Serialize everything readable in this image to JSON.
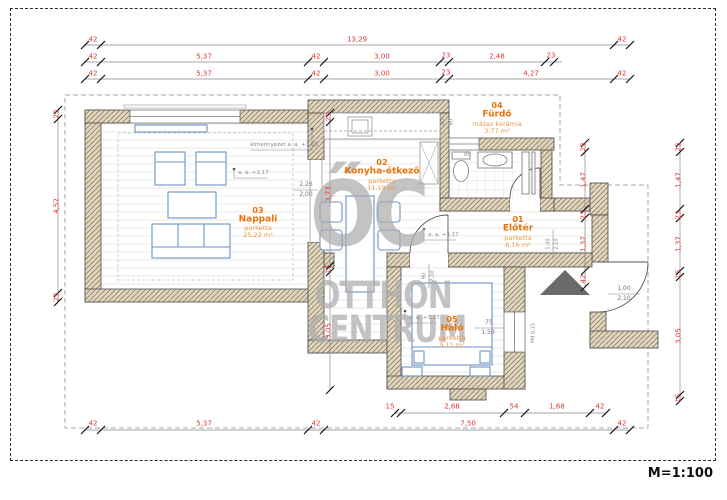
{
  "scale_label": "M=1:100",
  "watermark": {
    "logo": "ŐC",
    "line1": "OTTHON",
    "line2": "CENTRUM"
  },
  "rooms": {
    "nappali": {
      "number": "03",
      "name": "Nappali",
      "floor": "parketta",
      "area": "25,22 m²"
    },
    "konyha": {
      "number": "02",
      "name": "Konyha-étkező",
      "floor": "parketta",
      "area": "11,19 m²"
    },
    "furdo": {
      "number": "04",
      "name": "Fürdő",
      "floor": "mázas kerámia",
      "area": "3,77 m²"
    },
    "eloter": {
      "number": "01",
      "name": "Előtér",
      "floor": "parketta",
      "area": "6,16 m²"
    },
    "halo": {
      "number": "05",
      "name": "Háló",
      "floor": "parketta",
      "area": "9,11 m²"
    }
  },
  "dimensions": {
    "top_row1": [
      "42",
      "13,29",
      "42"
    ],
    "top_row2": [
      "42",
      "5,37",
      "42",
      "3,00",
      "23",
      "2,48",
      "23"
    ],
    "top_row3": [
      "42",
      "5,37",
      "42",
      "3,00",
      "23",
      "4,27",
      "42"
    ],
    "bottom_row1": [
      "15",
      "2,68",
      "54",
      "1,68",
      "42"
    ],
    "bottom_row2": [
      "42",
      "5,37",
      "42",
      "7,50",
      "42"
    ],
    "left": [
      "23",
      "4,52",
      "23"
    ],
    "inner_vertical": [
      "23",
      "3,73",
      "15",
      "3,05"
    ],
    "right_inner": [
      "23",
      "1,47",
      "23",
      "1,37",
      "42"
    ],
    "right_outer": [
      "23",
      "1,47",
      "23",
      "1,37",
      "15",
      "3,05",
      "15"
    ]
  },
  "annotations": {
    "ceiling": "álmennyezet a. a. +3,06",
    "h_living": "a. a. +3,17",
    "h_hall": "a. a. +3,17",
    "h_bed": "a. a. +3,17",
    "opening_w": "2,26",
    "opening_h": "2,00",
    "duct_a": "60",
    "duct_b": "60",
    "wc": "80",
    "bed_door_w": "90",
    "bed_door_h": "2,10",
    "hall_door_w": "1,00",
    "hall_door_h": "2,10",
    "entry_door_w": "1,00",
    "entry_door_h": "2,10",
    "bed_window_w": "75",
    "bed_window_h": "1,50",
    "bed_window_note": "PM 0,15"
  },
  "colors": {
    "dimension_red": "#e03535",
    "room_orange": "#e8730c",
    "wall_tan": "#e0d5bf",
    "furniture_blue": "#6b93c4",
    "watermark_grey": "#acacac"
  }
}
